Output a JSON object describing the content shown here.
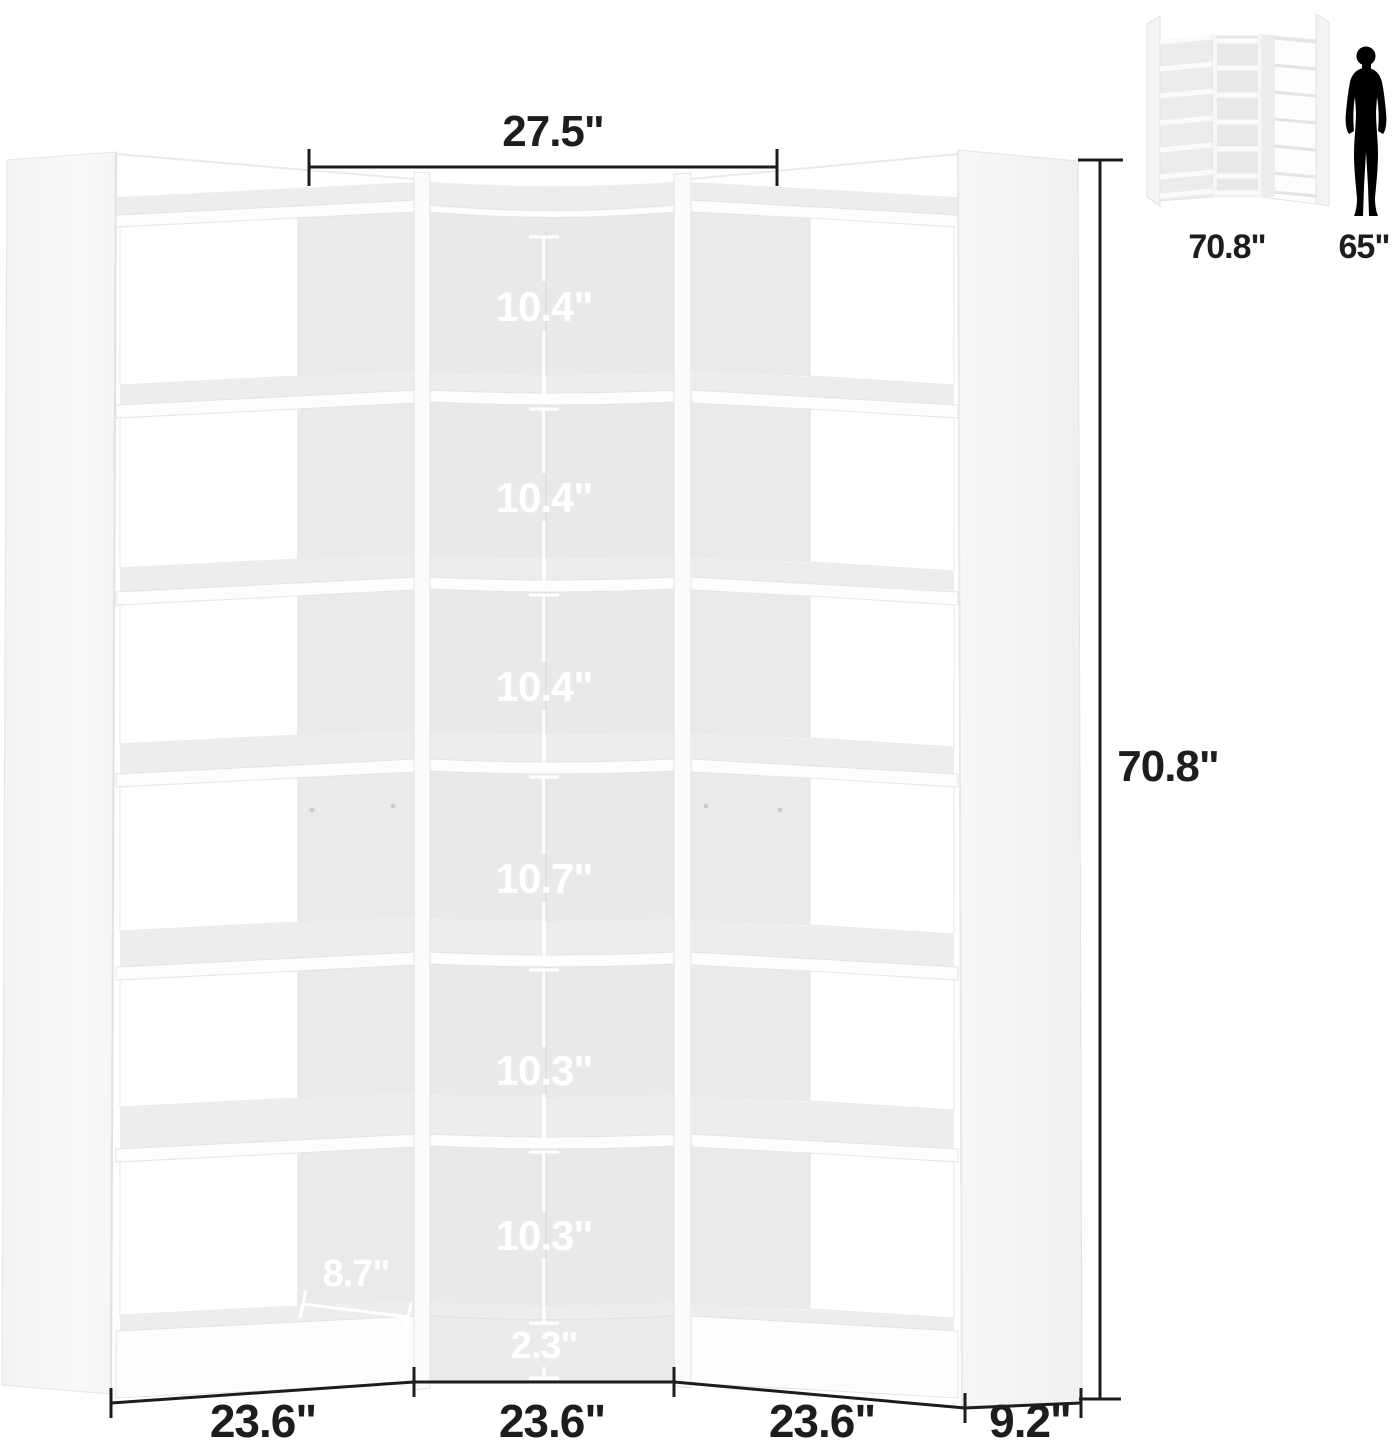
{
  "dimensions": {
    "top_width": "27.5\"",
    "total_height": "70.8\"",
    "shelf_spacings": [
      "10.4\"",
      "10.4\"",
      "10.4\"",
      "10.7\"",
      "10.3\"",
      "10.3\""
    ],
    "base_clearance": "2.3\"",
    "side_shelf_depth": "8.7\"",
    "section_widths": [
      "23.6\"",
      "23.6\"",
      "23.6\""
    ],
    "end_panel_depth": "9.2\""
  },
  "inset": {
    "unit_height_label": "70.8\"",
    "person_height_label": "65\""
  },
  "colors": {
    "annotation_dark": "#1d1d1f",
    "annotation_light": "#ffffff",
    "shelf_back_gray": "#e8e9e9",
    "panel_white": "#f5f6f6",
    "silhouette": "#000000"
  }
}
